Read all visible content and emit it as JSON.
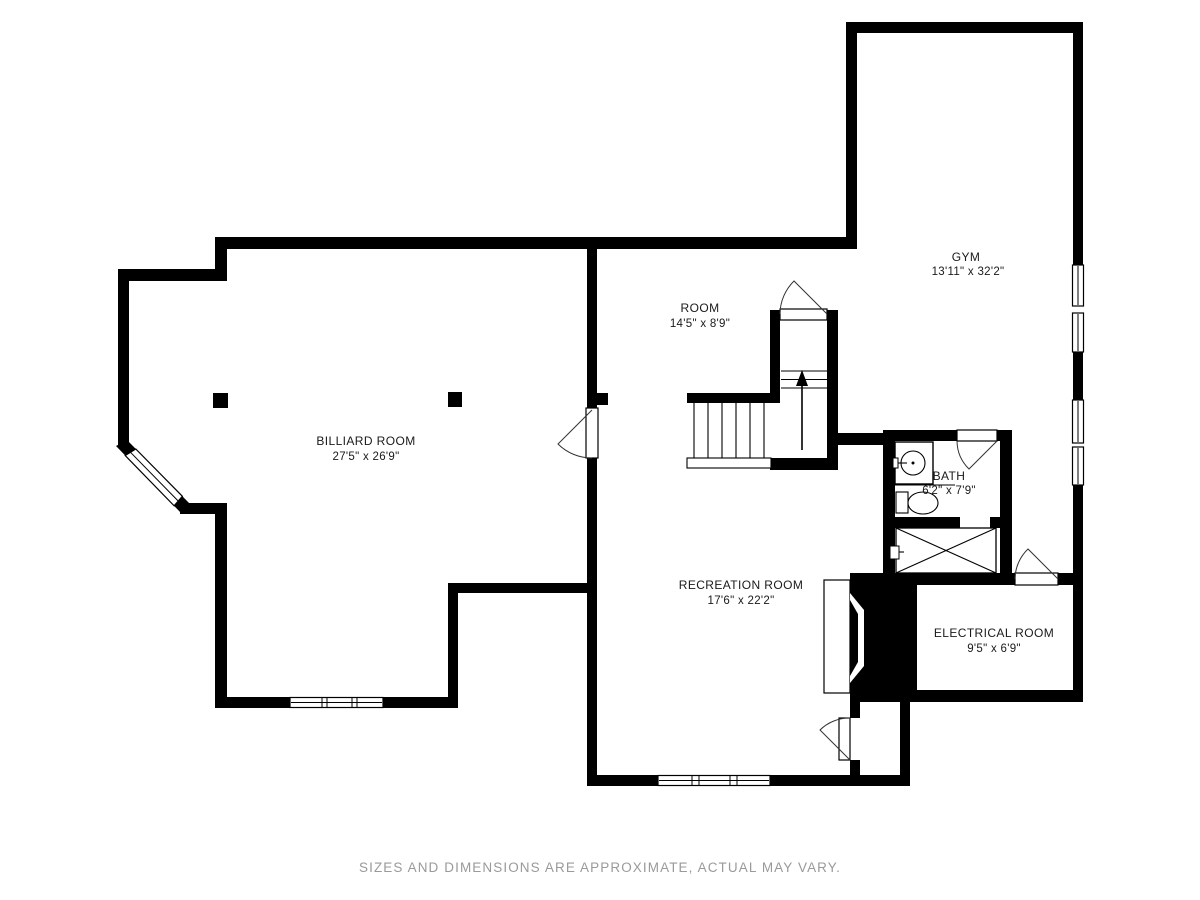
{
  "rooms": {
    "gym": {
      "name": "GYM",
      "dims": "13'11\" x 32'2\""
    },
    "room": {
      "name": "ROOM",
      "dims": "14'5\" x 8'9\""
    },
    "billiard": {
      "name": "BILLIARD ROOM",
      "dims": "27'5\" x 26'9\""
    },
    "bath": {
      "name": "BATH",
      "dims": "6'2\" x 7'9\""
    },
    "recreation": {
      "name": "RECREATION ROOM",
      "dims": "17'6\" x 22'2\""
    },
    "electrical": {
      "name": "ELECTRICAL ROOM",
      "dims": "9'5\" x 6'9\""
    }
  },
  "footer": {
    "disclaimer": "SIZES AND DIMENSIONS ARE APPROXIMATE, ACTUAL MAY VARY."
  },
  "stairs": {
    "direction": "up"
  },
  "colors": {
    "wall": "#000000",
    "background": "#ffffff",
    "disclaimer_text": "#9a9a9a",
    "label_text": "#1a1a1a"
  }
}
